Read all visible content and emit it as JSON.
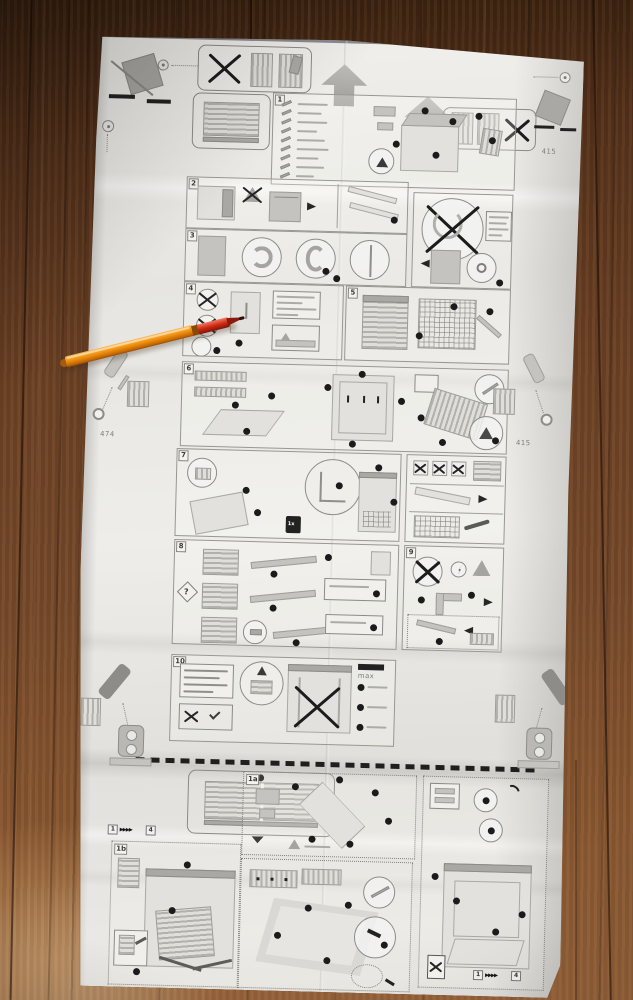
{
  "scene": {
    "description": "Folded appliance installation instruction leaflet (diagram-only manual) lying on a brown wooden plank floor, with an orange ballpoint pen resting diagonally on its upper-left area",
    "floor_colors": {
      "plank_dark": "#38200f",
      "plank_mid": "#6e4424",
      "plank_light": "#95623a"
    },
    "paper_colors": {
      "base": "#ecebe7",
      "shade": "#d9d8d4",
      "line": "#989892",
      "ink": "#1d1d1d"
    },
    "pen": {
      "kind": "orange-ballpoint-pen",
      "body_color": "#ef920e",
      "grip_color": "#cf2a14",
      "tip_color": "#2a1108"
    }
  },
  "sheet": {
    "labels": {
      "p1": "1",
      "p2": "2",
      "p3": "3",
      "p4": "4",
      "p5": "5",
      "p6": "6",
      "p7": "7",
      "p8": "8",
      "p9": "9",
      "p10": "10",
      "a1": "1a",
      "b1": "1b",
      "question": "?",
      "once": "1x",
      "max": "max"
    },
    "sequence": {
      "start": "1",
      "arrows": "▸▸▸▸",
      "end": "4"
    },
    "sequence2": {
      "start": "1",
      "arrows": "▸▸▸▸",
      "end": "4"
    },
    "dims": {
      "left": "474",
      "right": "415"
    },
    "icons": {
      "up-arrow": "▲",
      "no-tip-cross": "✕",
      "magnifier-detail": "○",
      "callout-dot": "●",
      "warning-triangle": "△",
      "pointer-down": "▼",
      "crossed-circle": "⊘",
      "recycle-bin": "♻",
      "question-diamond": "?"
    }
  }
}
